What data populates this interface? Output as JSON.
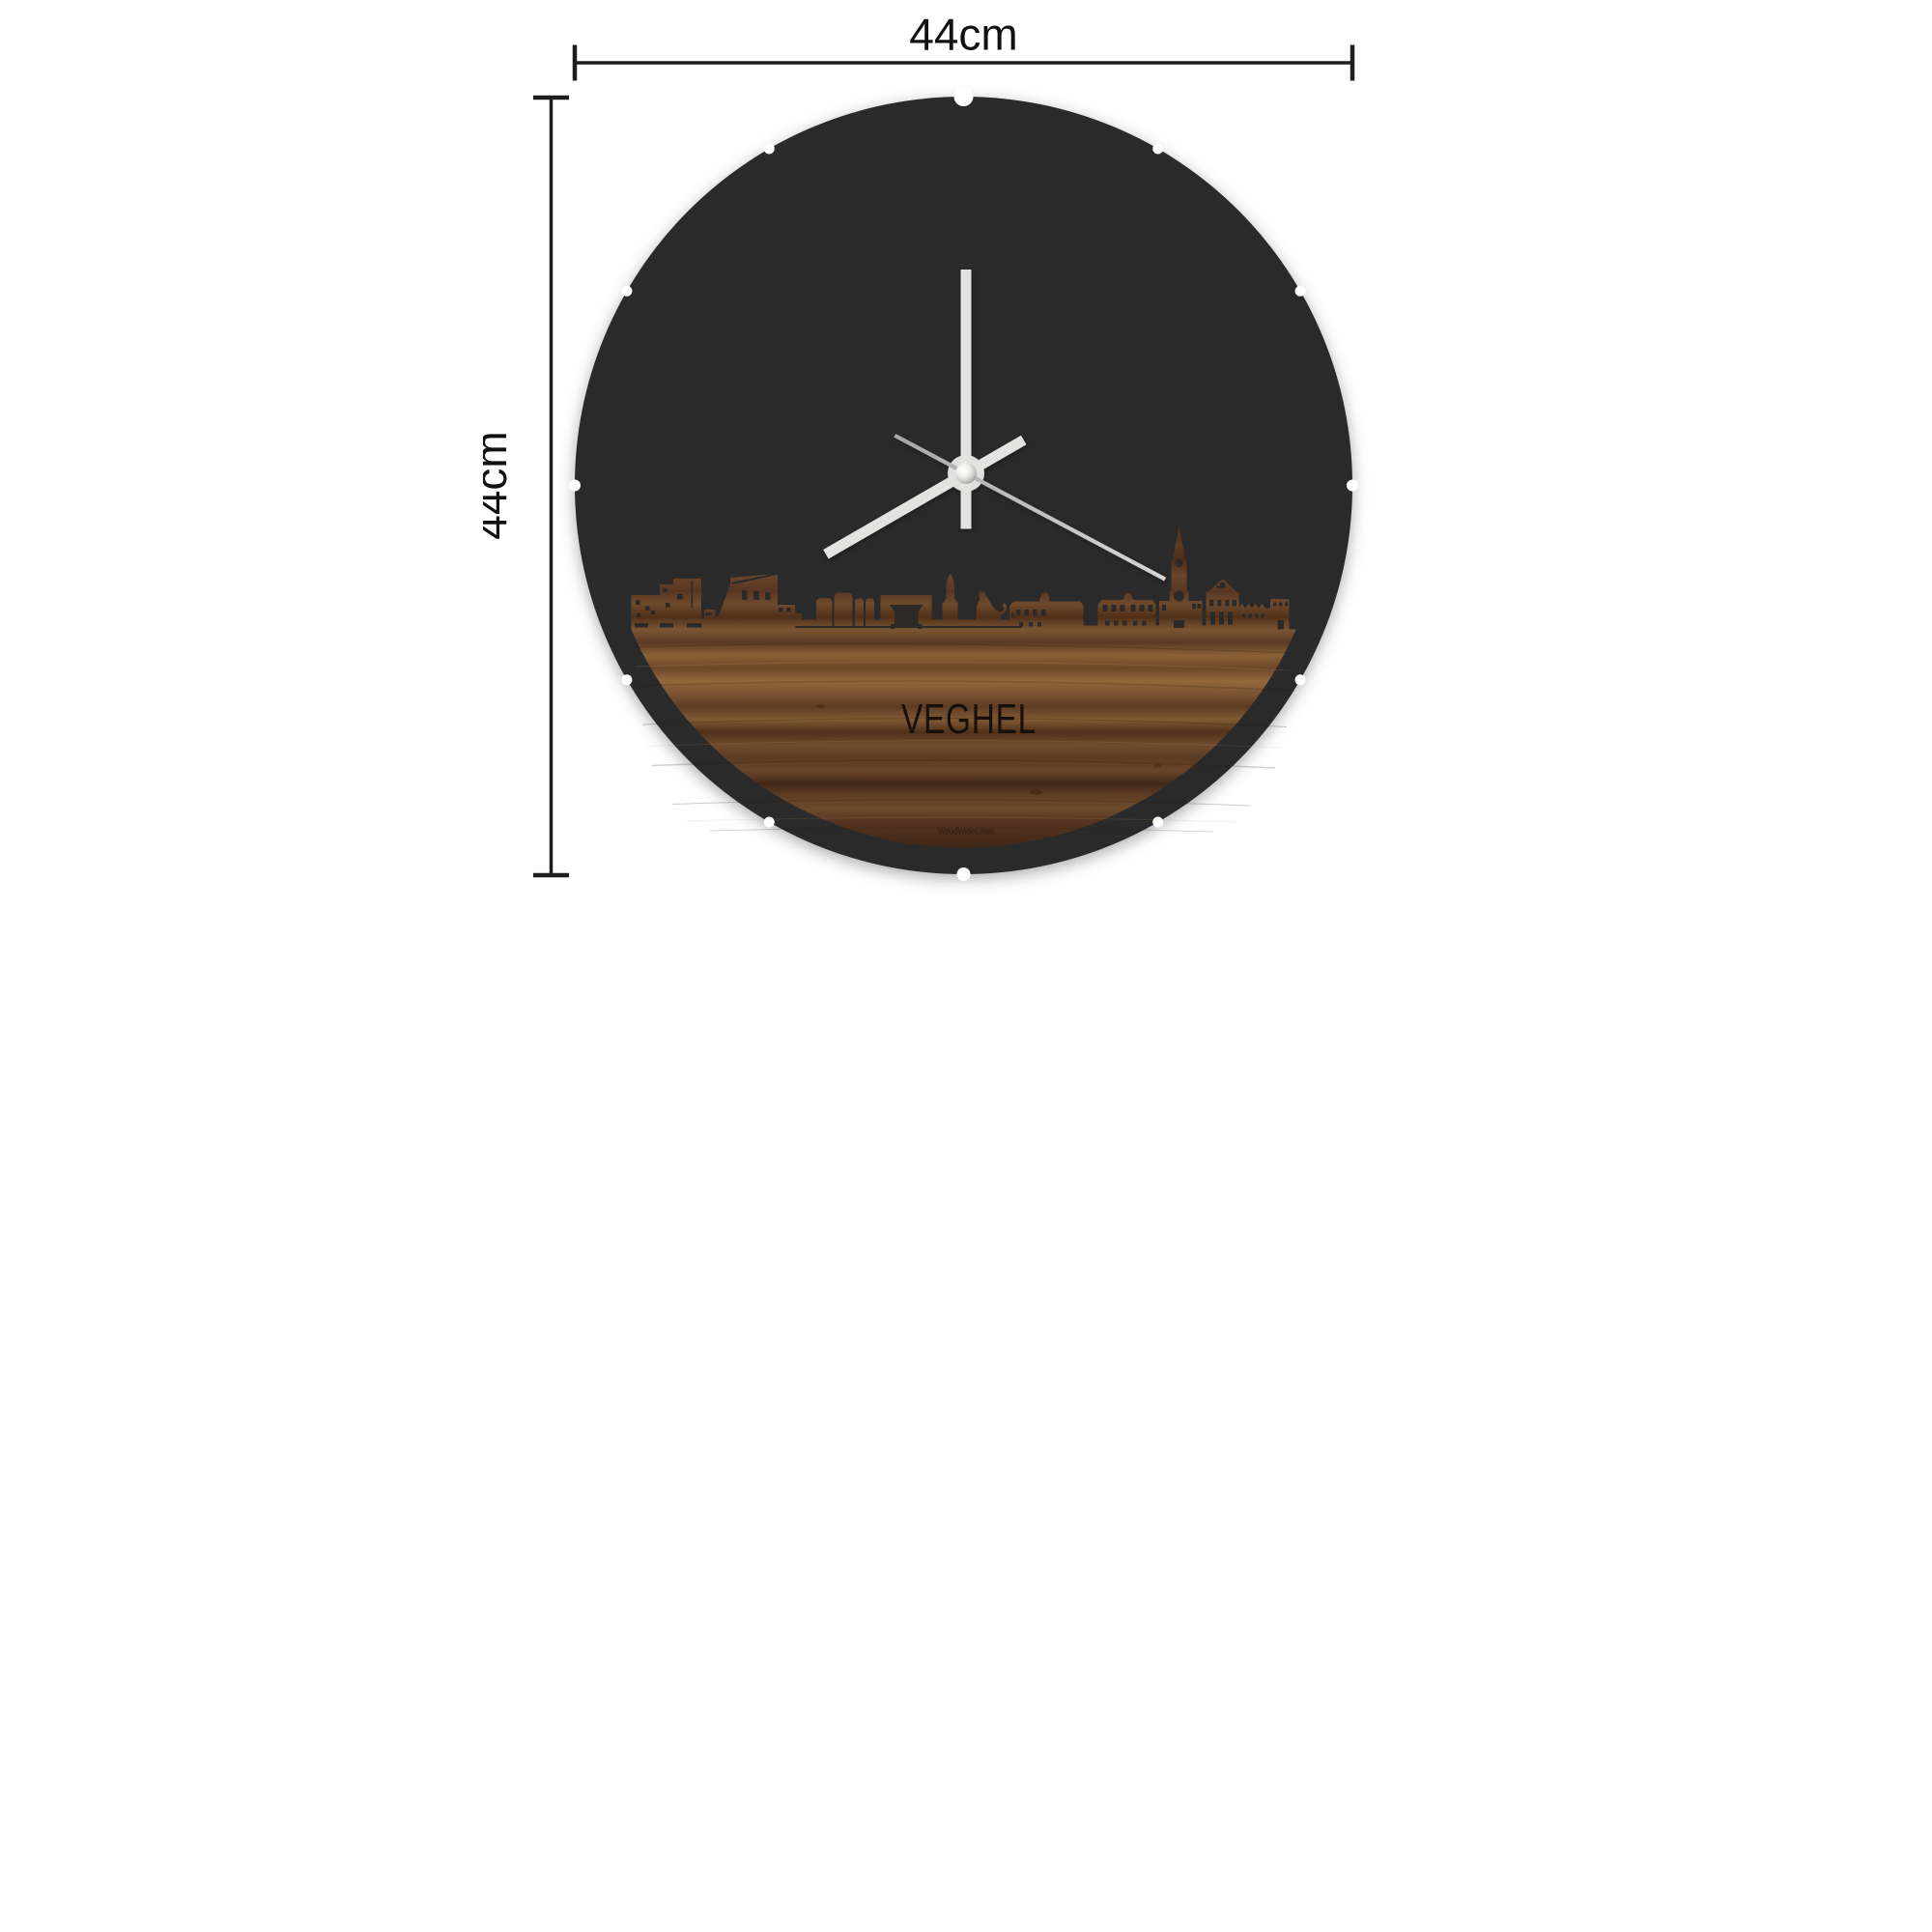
{
  "dimensions": {
    "width_label": "44cm",
    "height_label": "44cm"
  },
  "product": {
    "city_label": "VEGHEL",
    "watermark": "WoodWideCities"
  },
  "clock": {
    "notch_count": 12,
    "time": {
      "hour_angle_deg": 240,
      "minute_angle_deg": 0,
      "second_angle_deg": 118
    },
    "hour_transform": "rotate(240 1000 980)",
    "minute_transform": "rotate(0 1000 980)",
    "second_transform": "rotate(118 1000 980)"
  },
  "colors": {
    "background": "#ffffff",
    "face": "#2b2a29",
    "hands": "#e3e3e1",
    "second_hand": "#bfbfbf",
    "hub": "#e0dfde",
    "dimension_lines": "#1d1d1d",
    "wood_dark": "#3f2614",
    "wood_mid": "#6b4727",
    "wood_light": "#93683c"
  }
}
